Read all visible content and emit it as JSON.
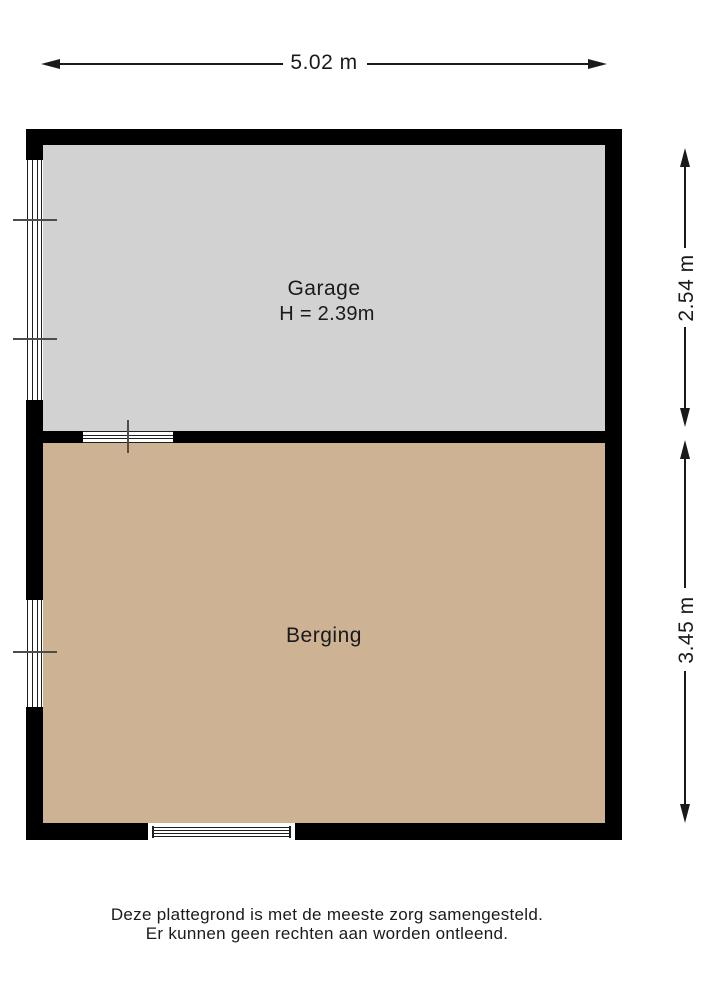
{
  "dimensions": {
    "width_label": "5.02 m",
    "garage_depth_label": "2.54 m",
    "berging_depth_label": "3.45 m"
  },
  "rooms": {
    "garage": {
      "name": "Garage",
      "height_note": "H = 2.39m"
    },
    "berging": {
      "name": "Berging"
    }
  },
  "disclaimer": {
    "line1": "Deze plattegrond is met de meeste zorg samengesteld.",
    "line2": "Er kunnen geen rechten aan worden ontleend."
  },
  "colors": {
    "wall": "#000000",
    "garage_fill": "#d2d2d2",
    "berging_fill": "#cdb293",
    "dimension": "#1a1a1a",
    "glass_bg": "#ffffff",
    "glass_line": "#1f1f1f",
    "tick": "#4d4d4d",
    "text": "#1a1a1a"
  }
}
